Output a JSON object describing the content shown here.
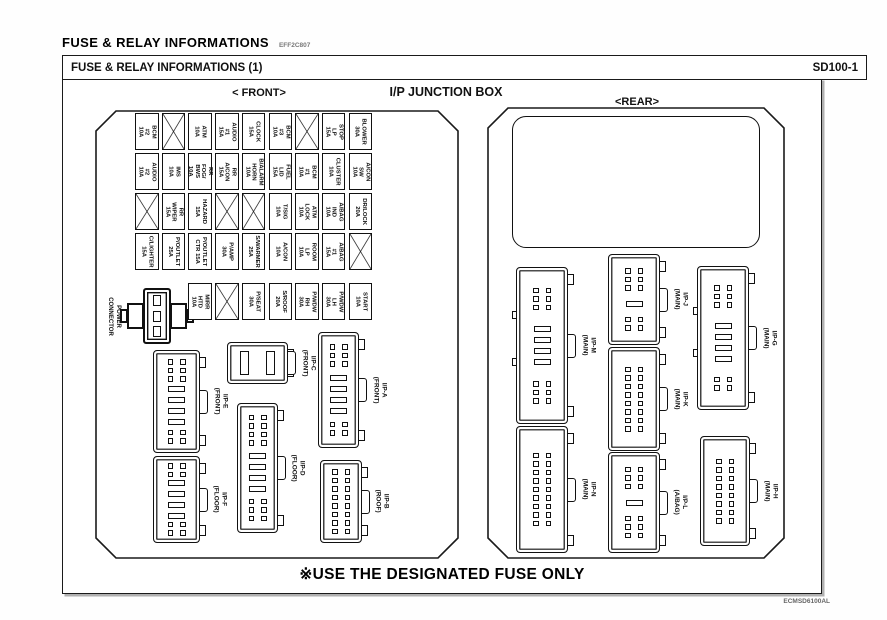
{
  "header": {
    "title": "FUSE  &  RELAY  INFORMATIONS",
    "code": "EFF2C807"
  },
  "panel": {
    "title": "FUSE & RELAY INFORMATIONS (1)",
    "page_code": "SD100-1",
    "notice": "※USE THE DESIGNATED FUSE ONLY",
    "footer_code": "ECMSD6100AL"
  },
  "sections": {
    "front_label": "< FRONT>",
    "center_label": "I/P JUNCTION BOX",
    "rear_label": "<REAR>"
  },
  "power_connector": {
    "label": "POWER\nCONNECTOR"
  },
  "fuse_grid": {
    "rows": [
      {
        "cells": [
          {
            "name": "BCM #2",
            "amp": "10A"
          },
          {
            "empty": true
          },
          {
            "name": "ATM",
            "amp": "10A"
          },
          {
            "name": "AUDIO #1",
            "amp": "15A"
          },
          {
            "name": "CLOCK",
            "amp": "15A"
          },
          {
            "name": "BCM #3",
            "amp": "10A"
          },
          {
            "empty": true
          },
          {
            "name": "STOP LP",
            "amp": "15A"
          },
          {
            "name": "BLOWER",
            "amp": "30A"
          }
        ]
      },
      {
        "cells": [
          {
            "name": "AUDIO #2",
            "amp": "10A"
          },
          {
            "name": "IMS",
            "amp": "10A"
          },
          {
            "name": "RR FOG/",
            "amp": "BWS 10A"
          },
          {
            "name": "RR A/CON",
            "amp": "15A"
          },
          {
            "name": "B/ALARM",
            "amp": "HORN 10A"
          },
          {
            "name": "FUEL LID",
            "amp": "15A"
          },
          {
            "name": "BCM #1",
            "amp": "10A"
          },
          {
            "name": "CLUSTER",
            "amp": "10A"
          },
          {
            "name": "A/CON SW",
            "amp": "10A"
          }
        ]
      },
      {
        "cells": [
          {
            "empty": true
          },
          {
            "name": "RR WIPER",
            "amp": "15A"
          },
          {
            "name": "HAZARD",
            "amp": "15A"
          },
          {
            "empty": true
          },
          {
            "empty": true
          },
          {
            "name": "T/SIG",
            "amp": "10A"
          },
          {
            "name": "ATM LOCK",
            "amp": "10A"
          },
          {
            "name": "A/BAG IND",
            "amp": "10A"
          },
          {
            "name": "DR/LOCK",
            "amp": "20A"
          }
        ]
      },
      {
        "cells": [
          {
            "name": "C/LIGHTER",
            "amp": "15A"
          },
          {
            "name": "P/OUTLET",
            "amp": "25A"
          },
          {
            "name": "P/OUTLET",
            "amp": "CTR 15A"
          },
          {
            "name": "P/AMP",
            "amp": "30A"
          },
          {
            "name": "S/WARMER",
            "amp": "25A"
          },
          {
            "name": "A/CON",
            "amp": "10A"
          },
          {
            "name": "ROOM LP",
            "amp": "10A"
          },
          {
            "name": "A/BAG #1",
            "amp": "15A"
          },
          {
            "empty": true
          }
        ]
      },
      {
        "offset": 2,
        "cells": [
          {
            "name": "MIRR HTD",
            "amp": "10A"
          },
          {
            "empty": true
          },
          {
            "name": "P/SEAT",
            "amp": "30A"
          },
          {
            "name": "S/ROOF",
            "amp": "20A"
          },
          {
            "name": "P/WDW RH",
            "amp": "30A"
          },
          {
            "name": "P/WDW LH",
            "amp": "30A"
          },
          {
            "name": "START",
            "amp": "10A"
          }
        ]
      }
    ]
  },
  "front_connectors": [
    {
      "id": "ip-e",
      "label": "I/P-E",
      "location": "(FRONT)"
    },
    {
      "id": "ip-c",
      "label": "I/P-C",
      "location": "(FRONT)"
    },
    {
      "id": "ip-a",
      "label": "I/P-A",
      "location": "(FRONT)"
    },
    {
      "id": "ip-f",
      "label": "I/P-F",
      "location": "(FLOOR)"
    },
    {
      "id": "ip-d",
      "label": "I/P-D",
      "location": "(FLOOR)"
    },
    {
      "id": "ip-b",
      "label": "I/P-B",
      "location": "(ROOF)"
    }
  ],
  "rear_connectors": [
    {
      "id": "ip-m",
      "label": "I/P-M",
      "location": "(MAIN)"
    },
    {
      "id": "ip-n",
      "label": "I/P-N",
      "location": "(MAIN)"
    },
    {
      "id": "ip-j",
      "label": "I/P-J",
      "location": "(MAIN)"
    },
    {
      "id": "ip-k",
      "label": "I/P-K",
      "location": "(MAIN)"
    },
    {
      "id": "ip-l",
      "label": "I/P-L",
      "location": "(A/BAG)"
    },
    {
      "id": "ip-g",
      "label": "I/P-G",
      "location": "(MAIN)"
    },
    {
      "id": "ip-h",
      "label": "I/P-H",
      "location": "(MAIN)"
    }
  ]
}
